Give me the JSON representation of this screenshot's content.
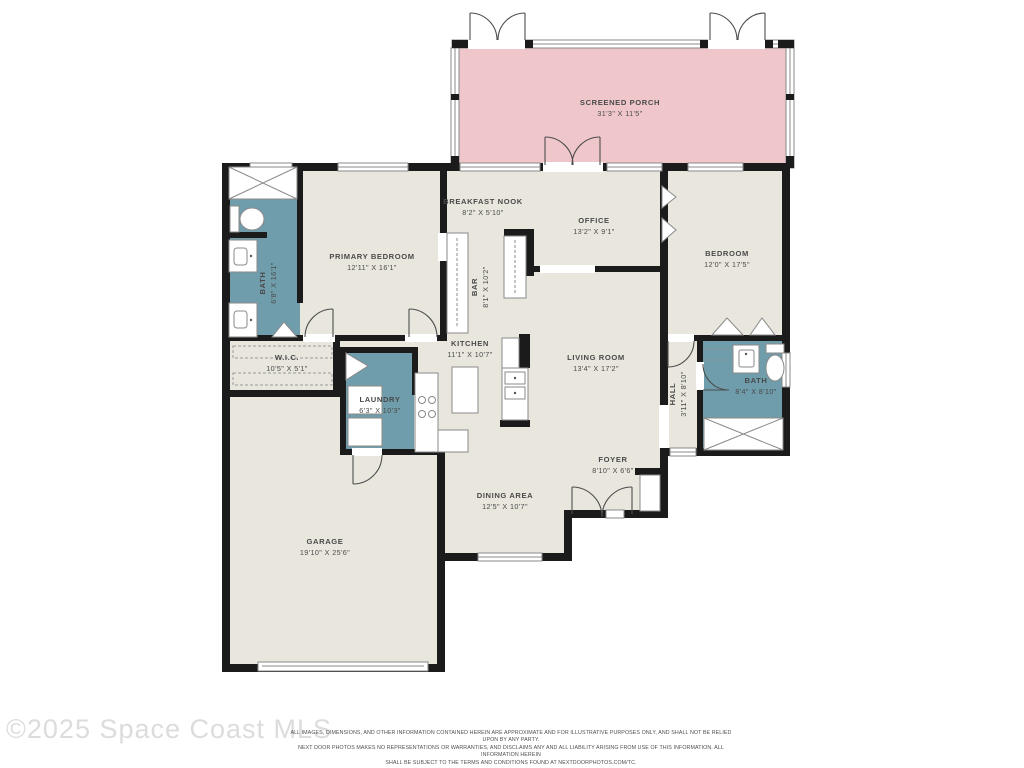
{
  "watermark": {
    "text": "©2025 Space Coast MLS"
  },
  "disclaimer": {
    "line1": "ALL IMAGES, DIMENSIONS, AND OTHER INFORMATION CONTAINED HEREIN ARE APPROXIMATE AND FOR ILLUSTRATIVE PURPOSES ONLY, AND SHALL NOT BE RELIED UPON BY ANY PARTY.",
    "line2": "NEXT DOOR PHOTOS MAKES NO REPRESENTATIONS OR WARRANTIES, AND DISCLAIMS ANY AND ALL LIABILITY ARISING FROM USE OF THIS INFORMATION. ALL INFORMATION HEREIN",
    "line3": "SHALL BE SUBJECT TO THE TERMS AND CONDITIONS FOUND AT NEXTDOORPHOTOS.COM/TC."
  },
  "colors": {
    "floor": "#e8e6dd",
    "porch": "#efc7cb",
    "wet_room": "#6f9dab",
    "wall": "#1b1b1b",
    "label_text": "#4a4a4a",
    "watermark": "#dcdcdc"
  },
  "rooms": {
    "screened_porch": {
      "name": "SCREENED PORCH",
      "dims": "31'3\" X 11'5\""
    },
    "breakfast_nook": {
      "name": "BREAKFAST NOOK",
      "dims": "8'2\" X 5'10\""
    },
    "office": {
      "name": "OFFICE",
      "dims": "13'2\" X 9'1\""
    },
    "primary_bedroom": {
      "name": "PRIMARY BEDROOM",
      "dims": "12'11\" X 16'1\""
    },
    "primary_bath": {
      "name": "BATH",
      "dims": "6'8\" X 16'1\""
    },
    "bedroom": {
      "name": "BEDROOM",
      "dims": "12'0\" X 17'5\""
    },
    "wic": {
      "name": "W.I.C.",
      "dims": "10'5\" X 5'1\""
    },
    "bar": {
      "name": "BAR",
      "dims": "8'1\" X 10'2\""
    },
    "kitchen": {
      "name": "KITCHEN",
      "dims": "11'1\" X 10'7\""
    },
    "living_room": {
      "name": "LIVING ROOM",
      "dims": "13'4\" X 17'2\""
    },
    "laundry": {
      "name": "LAUNDRY",
      "dims": "6'3\" X 10'3\""
    },
    "hall": {
      "name": "HALL",
      "dims": "3'11\" X 8'10\""
    },
    "bath2": {
      "name": "BATH",
      "dims": "8'4\" X 8'10\""
    },
    "foyer": {
      "name": "FOYER",
      "dims": "8'10\" X 6'6\""
    },
    "dining_area": {
      "name": "DINING AREA",
      "dims": "12'5\" X 10'7\""
    },
    "garage": {
      "name": "GARAGE",
      "dims": "19'10\" X 25'6\""
    }
  }
}
